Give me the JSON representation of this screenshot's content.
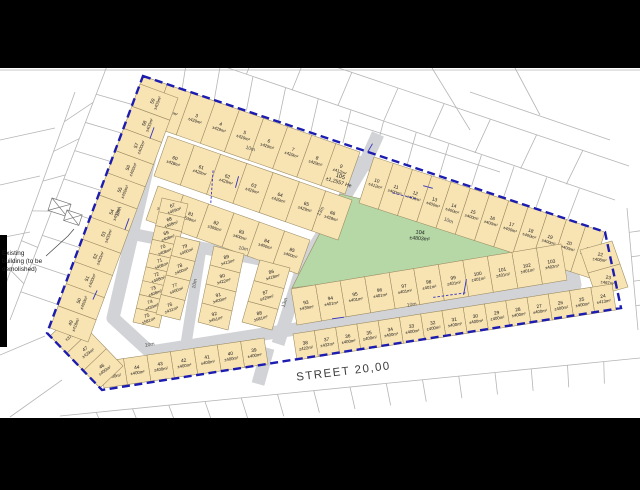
{
  "labels": {
    "street": "STREET 20,00",
    "note_line1": "Existing",
    "note_line2": "building (to be",
    "note_line3": "demolished)",
    "park_number": "104",
    "park_area": "±4803m²",
    "street_lot_number": "105",
    "street_lot_area": "±1,2557 He"
  },
  "colors": {
    "black_bar": "#000000",
    "map_bg": "#ffffff",
    "lot_fill": "#f8e3b3",
    "lot_stroke": "#9a8a60",
    "street_fill": "#d2d3d6",
    "park_fill": "#b5d8a6",
    "boundary": "#1c1cb0",
    "parcel_line": "#b5b5b5",
    "text": "#1a1a1a",
    "dim_blue": "#3333c0",
    "width_label": "#4a4a4a"
  },
  "boundary": {
    "points": [
      [
        143,
        76
      ],
      [
        605,
        232
      ],
      [
        621,
        308
      ],
      [
        102,
        390
      ],
      [
        47,
        333
      ]
    ],
    "dash": "8 4.5",
    "width": 2.4
  },
  "streets": {
    "ring": [
      [
        158,
        122
      ],
      [
        262,
        151
      ],
      [
        365,
        163
      ],
      [
        555,
        238
      ],
      [
        570,
        258
      ],
      [
        575,
        285
      ],
      [
        150,
        352
      ],
      [
        113,
        318
      ]
    ],
    "internal": [
      {
        "name": "street-13m-upper",
        "points": [
          [
            365,
            163
          ],
          [
            302,
            268
          ]
        ],
        "w": 13
      },
      {
        "name": "street-10m-west",
        "points": [
          [
            133,
            234
          ],
          [
            302,
            268
          ]
        ],
        "w": 12
      },
      {
        "name": "street-13m-lower",
        "points": [
          [
            302,
            268
          ],
          [
            278,
            344
          ]
        ],
        "w": 13
      },
      {
        "name": "street-10m-mid",
        "points": [
          [
            202,
            242
          ],
          [
            186,
            344
          ]
        ],
        "w": 11
      },
      {
        "name": "entrance-south",
        "points": [
          [
            268,
            348
          ],
          [
            258,
            384
          ]
        ],
        "w": 13
      },
      {
        "name": "entrance-north",
        "points": [
          [
            365,
            163
          ],
          [
            378,
            134
          ]
        ],
        "w": 13
      }
    ],
    "ring_width": 13
  },
  "park": {
    "points": [
      [
        340,
        194
      ],
      [
        545,
        242
      ],
      [
        550,
        254
      ],
      [
        292,
        288
      ],
      [
        303,
        266
      ]
    ],
    "label_x": 420,
    "label_y": 234,
    "rot": 5
  },
  "street_lot_label": {
    "x": 340,
    "y": 178,
    "rot": 17
  },
  "width_labels": [
    {
      "t": "10m",
      "x": 250,
      "y": 150,
      "r": 16
    },
    {
      "t": "10m",
      "x": 448,
      "y": 222,
      "r": 21
    },
    {
      "t": "10m",
      "x": 120,
      "y": 212,
      "r": -70
    },
    {
      "t": "10m",
      "x": 196,
      "y": 284,
      "r": -78
    },
    {
      "t": "10m",
      "x": 243,
      "y": 250,
      "r": 12
    },
    {
      "t": "10m",
      "x": 150,
      "y": 346,
      "r": -9
    },
    {
      "t": "10m",
      "x": 412,
      "y": 306,
      "r": -9
    },
    {
      "t": "13m",
      "x": 322,
      "y": 212,
      "r": -59
    },
    {
      "t": "13m",
      "x": 286,
      "y": 303,
      "r": -72
    }
  ],
  "strips": [
    {
      "front": [
        143,
        76,
        360,
        152
      ],
      "depth": [
        -15,
        42
      ],
      "rot": 19,
      "lots": [
        {
          "n": "1",
          "a": "±457m²"
        },
        {
          "n": "2",
          "a": "±413m²"
        },
        {
          "n": "3",
          "a": "±429m²"
        },
        {
          "n": "4",
          "a": "±429m²"
        },
        {
          "n": "5",
          "a": "±429m²"
        },
        {
          "n": "6",
          "a": "±429m²"
        },
        {
          "n": "7",
          "a": "±429m²"
        },
        {
          "n": "8",
          "a": "±429m²"
        },
        {
          "n": "9",
          "a": "±412m²"
        }
      ]
    },
    {
      "front": [
        374,
        157,
        605,
        232
      ],
      "depth": [
        -15,
        46
      ],
      "rot": 18,
      "lots": [
        {
          "n": "10",
          "a": "±412m²"
        },
        {
          "n": "11",
          "a": "±400m²"
        },
        {
          "n": "12",
          "a": "±400m²"
        },
        {
          "n": "13",
          "a": "±400m²"
        },
        {
          "n": "14",
          "a": "±400m²"
        },
        {
          "n": "15",
          "a": "±400m²"
        },
        {
          "n": "16",
          "a": "±400m²"
        },
        {
          "n": "17",
          "a": "±400m²"
        },
        {
          "n": "18",
          "a": "±400m²"
        },
        {
          "n": "19",
          "a": "±400m²"
        },
        {
          "n": "20",
          "a": "±400m²"
        },
        {
          "n": "21",
          "a": "±418m²"
        }
      ]
    },
    {
      "front": [
        580,
        250,
        596,
        296
      ],
      "depth": [
        32,
        -9
      ],
      "rot": 8,
      "lots": [
        {
          "n": "22",
          "a": "±408m²"
        },
        {
          "n": "23",
          "a": "±467m²"
        }
      ]
    },
    {
      "front": [
        616,
        310,
        297,
        360
      ],
      "depth": [
        -4,
        -26
      ],
      "rot": -9,
      "lots": [
        {
          "n": "24",
          "a": "±413m²"
        },
        {
          "n": "25",
          "a": "±400m²"
        },
        {
          "n": "26",
          "a": "±400m²"
        },
        {
          "n": "27",
          "a": "±400m²"
        },
        {
          "n": "28",
          "a": "±400m²"
        },
        {
          "n": "29",
          "a": "±400m²"
        },
        {
          "n": "30",
          "a": "±400m²"
        },
        {
          "n": "31",
          "a": "±400m²"
        },
        {
          "n": "32",
          "a": "±400m²"
        },
        {
          "n": "33",
          "a": "±400m²"
        },
        {
          "n": "34",
          "a": "±400m²"
        },
        {
          "n": "35",
          "a": "±400m²"
        },
        {
          "n": "36",
          "a": "±400m²"
        },
        {
          "n": "37",
          "a": "±432m²"
        },
        {
          "n": "38",
          "a": "±422m²"
        }
      ]
    },
    {
      "front": [
        268,
        364,
        104,
        388
      ],
      "depth": [
        -4,
        -26
      ],
      "rot": -9,
      "lots": [
        {
          "n": "39",
          "a": "±400m²"
        },
        {
          "n": "40",
          "a": "±400m²"
        },
        {
          "n": "41",
          "a": "±400m²"
        },
        {
          "n": "42",
          "a": "±400m²"
        },
        {
          "n": "43",
          "a": "±400m²"
        },
        {
          "n": "44",
          "a": "±400m²"
        },
        {
          "n": "45",
          "a": "±400m²"
        }
      ]
    },
    {
      "front": [
        100,
        388,
        50,
        336
      ],
      "depth": [
        23,
        -22
      ],
      "rot": -35,
      "lots": [
        {
          "n": "46",
          "a": "±400m²"
        },
        {
          "n": "47",
          "a": "±429m²"
        },
        {
          "n": "48",
          "a": "±379m²"
        }
      ]
    },
    {
      "front": [
        50,
        328,
        140,
        84
      ],
      "depth": [
        38,
        14
      ],
      "rot": -68,
      "lots": [
        {
          "n": "49",
          "a": "±418m²"
        },
        {
          "n": "50",
          "a": "±400m²"
        },
        {
          "n": "51",
          "a": "±400m²"
        },
        {
          "n": "52",
          "a": "±400m²"
        },
        {
          "n": "53",
          "a": "±400m²"
        },
        {
          "n": "54",
          "a": "±400m²"
        },
        {
          "n": "55",
          "a": "±400m²"
        },
        {
          "n": "56",
          "a": "±400m²"
        },
        {
          "n": "57",
          "a": "±400m²"
        },
        {
          "n": "58",
          "a": "±400m²"
        },
        {
          "n": "59",
          "a": "±400m²"
        }
      ]
    },
    {
      "front": [
        168,
        136,
        352,
        200
      ],
      "depth": [
        -14,
        40
      ],
      "rot": 19,
      "lots": [
        {
          "n": "60",
          "a": "±428m²"
        },
        {
          "n": "61",
          "a": "±429m²"
        },
        {
          "n": "62",
          "a": "±429m²"
        },
        {
          "n": "63",
          "a": "±429m²"
        },
        {
          "n": "64",
          "a": "±429m²"
        },
        {
          "n": "65",
          "a": "±429m²"
        },
        {
          "n": "66",
          "a": "±428m²"
        }
      ]
    },
    {
      "front": [
        158,
        186,
        310,
        240
      ],
      "depth": [
        -12,
        34
      ],
      "rot": 19,
      "lots": [
        {
          "n": "80",
          "a": "±402m²"
        },
        {
          "n": "81",
          "a": "±539m²"
        },
        {
          "n": "82",
          "a": "±395m²"
        },
        {
          "n": "83",
          "a": "±400m²"
        },
        {
          "n": "84",
          "a": "±400m²"
        },
        {
          "n": "85",
          "a": "±400m²"
        }
      ]
    },
    {
      "front": [
        162,
        198,
        133,
        322
      ],
      "depth": [
        26,
        6
      ],
      "rot": -20,
      "lots": [
        {
          "n": "67",
          "a": "±409m²"
        },
        {
          "n": "68",
          "a": "±408m²"
        },
        {
          "n": "69",
          "a": "±408m²"
        },
        {
          "n": "70",
          "a": "±408m²"
        },
        {
          "n": "71",
          "a": "±408m²"
        },
        {
          "n": "72",
          "a": "±408m²"
        },
        {
          "n": "73",
          "a": "±408m²"
        },
        {
          "n": "74",
          "a": "±433m²"
        },
        {
          "n": "75",
          "a": "±581m²"
        }
      ]
    },
    {
      "front": [
        200,
        242,
        180,
        320
      ],
      "depth": [
        -24,
        -6
      ],
      "rot": -20,
      "lots": [
        {
          "n": "79",
          "a": "±400m²"
        },
        {
          "n": "78",
          "a": "±400m²"
        },
        {
          "n": "77",
          "a": "±400m²"
        },
        {
          "n": "76",
          "a": "±431m²"
        }
      ]
    },
    {
      "front": [
        214,
        246,
        198,
        322
      ],
      "depth": [
        30,
        8
      ],
      "rot": -15,
      "lots": [
        {
          "n": "89",
          "a": "±413m²"
        },
        {
          "n": "90",
          "a": "±422m²"
        },
        {
          "n": "91",
          "a": "±409m²"
        },
        {
          "n": "92",
          "a": "±451m²"
        }
      ]
    },
    {
      "front": [
        290,
        268,
        272,
        330
      ],
      "depth": [
        -30,
        -8
      ],
      "rot": -15,
      "lots": [
        {
          "n": "86",
          "a": "±418m²"
        },
        {
          "n": "87",
          "a": "±429m²"
        },
        {
          "n": "88",
          "a": "±581m²"
        }
      ]
    },
    {
      "front": [
        297,
        325,
        567,
        280
      ],
      "depth": [
        -6,
        -36
      ],
      "rot": -9,
      "lots": [
        {
          "n": "93",
          "a": "±439m²"
        },
        {
          "n": "94",
          "a": "±401m²"
        },
        {
          "n": "95",
          "a": "±401m²"
        },
        {
          "n": "96",
          "a": "±401m²"
        },
        {
          "n": "97",
          "a": "±401m²"
        },
        {
          "n": "98",
          "a": "±401m²"
        },
        {
          "n": "99",
          "a": "±401m²"
        },
        {
          "n": "100",
          "a": "±401m²"
        },
        {
          "n": "101",
          "a": "±401m²"
        },
        {
          "n": "102",
          "a": "±401m²"
        },
        {
          "n": "103",
          "a": "±402m²"
        }
      ]
    }
  ],
  "background": {
    "lines": [
      [
        10,
        320,
        107,
        66
      ],
      [
        0,
        300,
        75,
        92
      ],
      [
        155,
        43,
        615,
        200
      ],
      [
        167,
        10,
        629,
        166
      ],
      [
        627,
        208,
        638,
        330
      ],
      [
        60,
        416,
        640,
        358
      ],
      [
        0,
        355,
        45,
        336
      ],
      [
        10,
        417,
        62,
        380
      ],
      [
        340,
        120,
        500,
        172
      ],
      [
        470,
        92,
        610,
        140
      ],
      [
        432,
        68,
        470,
        130
      ],
      [
        515,
        68,
        540,
        115
      ],
      [
        0,
        140,
        55,
        128
      ],
      [
        0,
        185,
        40,
        176
      ],
      [
        0,
        238,
        30,
        232
      ],
      [
        0,
        70,
        640,
        70
      ]
    ],
    "tick_rows": [
      {
        "a1": [
          47,
          333
        ],
        "a2": [
          143,
          76
        ],
        "b1": [
          10,
          320
        ],
        "b2": [
          107,
          66
        ],
        "n": 8
      },
      {
        "a1": [
          10,
          320
        ],
        "a2": [
          107,
          66
        ],
        "b1": [
          0,
          300
        ],
        "b2": [
          75,
          92
        ],
        "n": 6
      },
      {
        "a1": [
          150,
          78
        ],
        "a2": [
          600,
          230
        ],
        "b1": [
          155,
          43
        ],
        "b2": [
          612,
          200
        ],
        "n": 13
      },
      {
        "a1": [
          155,
          43
        ],
        "a2": [
          612,
          200
        ],
        "b1": [
          167,
          10
        ],
        "b2": [
          629,
          166
        ],
        "n": 9
      },
      {
        "a1": [
          60,
          416
        ],
        "a2": [
          640,
          358
        ],
        "b1": [
          70,
          438
        ],
        "b2": [
          640,
          380
        ],
        "n": 15
      },
      {
        "a1": [
          627,
          208
        ],
        "a2": [
          638,
          330
        ],
        "b1": [
          640,
          206
        ],
        "b2": [
          640,
          330
        ],
        "n": 4
      }
    ]
  },
  "dim_marks": [
    {
      "x": 152,
      "y": 133,
      "r": -70,
      "len": 12,
      "dash": false
    },
    {
      "x": 237,
      "y": 182,
      "r": -75,
      "len": 12,
      "dash": false
    },
    {
      "x": 212,
      "y": 186,
      "r": -86,
      "len": 34,
      "dash": true
    },
    {
      "x": 370,
      "y": 148,
      "r": -60,
      "len": 10,
      "dash": false
    },
    {
      "x": 405,
      "y": 196,
      "r": 14,
      "len": 26,
      "dash": true
    },
    {
      "x": 428,
      "y": 187,
      "r": 15,
      "len": 10,
      "dash": false
    },
    {
      "x": 95,
      "y": 295,
      "r": -65,
      "len": 10,
      "dash": false
    },
    {
      "x": 127,
      "y": 224,
      "r": -70,
      "len": 12,
      "dash": false
    },
    {
      "x": 465,
      "y": 287,
      "r": -80,
      "len": 16,
      "dash": false
    },
    {
      "x": 450,
      "y": 295,
      "r": -8,
      "len": 34,
      "dash": true
    },
    {
      "x": 338,
      "y": 318,
      "r": -8,
      "len": 12,
      "dash": false
    }
  ],
  "existing_building": {
    "rects": [
      {
        "x": 52,
        "y": 198,
        "w": 20,
        "h": 13,
        "r": 18
      },
      {
        "x": 67,
        "y": 210,
        "w": 16,
        "h": 11,
        "r": 18
      }
    ],
    "leader": [
      [
        46,
        256
      ],
      [
        68,
        236
      ],
      [
        74,
        229
      ]
    ]
  },
  "black_bars": {
    "top": [
      0,
      0,
      640,
      68
    ],
    "bottom": [
      0,
      418,
      640,
      72
    ],
    "left": [
      0,
      235,
      7,
      112
    ]
  }
}
